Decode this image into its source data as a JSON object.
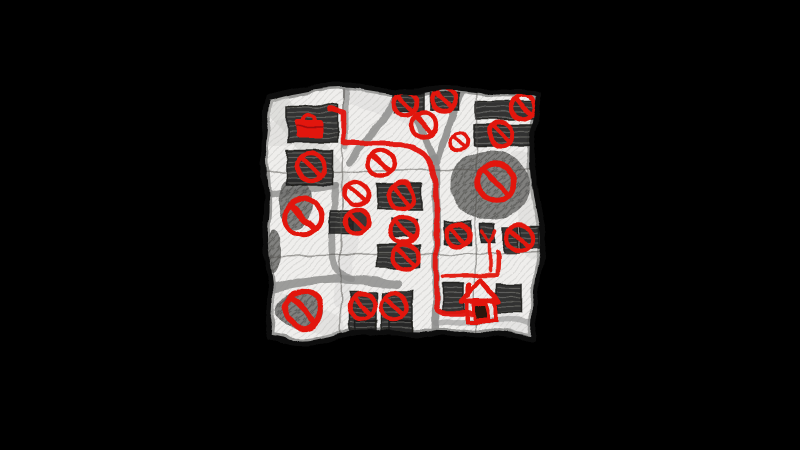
{
  "meta": {
    "kind": "hand-drawn-sketch-map",
    "background": "#000000"
  },
  "palette": {
    "paper": "#efeeec",
    "paper_shade": "#c6c6c3",
    "ink_outline": "#0c0c0c",
    "pencil_road": "#8d8d8c",
    "building_fill": "#282827",
    "building_stripe": "#565654",
    "foliage_fill": "#6e6e6c",
    "foliage_stripe": "#4e4e4c",
    "crease": "#4f4d4a",
    "red": "#e2150c",
    "door_fill": "#2a1410"
  },
  "paper": {
    "outline_path": "M268,97 C300,90 330,82 358,86 C385,90 405,95 428,90 C450,85 470,90 498,92 C515,93 530,91 539,95 C536,120 531,140 532,162 C533,185 537,205 542,228 C544,250 538,270 536,292 C535,310 534,325 533,340 C510,336 488,332 465,334 C445,336 425,333 405,334 C385,335 368,329 348,334 C330,338 312,346 295,343 C285,341 275,339 268,338 C270,315 272,298 269,278 C266,258 262,240 265,220 C267,200 264,182 263,162 C262,140 266,118 268,97 Z",
    "creases": [
      "M266,173 C350,168 450,174 537,169",
      "M263,257 C350,252 450,257 539,252",
      "M344,89 C341,170 342,260 340,338",
      "M478,92 C475,170 476,260 474,337"
    ],
    "shade_strokes": [
      {
        "d": "M276,101 L338,180",
        "w": 26,
        "o": 0.4
      },
      {
        "d": "M265,135 L302,130",
        "w": 26,
        "o": 0.3
      },
      {
        "d": "M352,95 L420,118",
        "w": 20,
        "o": 0.22
      },
      {
        "d": "M520,160 L534,250",
        "w": 20,
        "o": 0.3
      },
      {
        "d": "M270,300 L332,326",
        "w": 24,
        "o": 0.28
      },
      {
        "d": "M448,300 L530,330",
        "w": 18,
        "o": 0.22
      },
      {
        "d": "M350,240 L340,300",
        "w": 16,
        "o": 0.22
      }
    ]
  },
  "roads": [
    {
      "d": "M435,158 L437,220 L435,332",
      "w": 8,
      "o": 0.9
    },
    {
      "d": "M403,88 C414,112 426,136 434,160",
      "w": 7,
      "o": 0.9
    },
    {
      "d": "M400,89 C390,108 378,126 366,142 L350,162",
      "w": 7,
      "o": 0.85
    },
    {
      "d": "M464,88 C454,110 444,136 437,163",
      "w": 7,
      "o": 0.9
    },
    {
      "d": "M346,87 L346,146",
      "w": 6,
      "o": 0.7
    },
    {
      "d": "M264,196 C290,192 315,188 336,186",
      "w": 7,
      "o": 0.8
    },
    {
      "d": "M336,186 C333,210 331,235 334,258 C336,270 340,276 352,278",
      "w": 7,
      "o": 0.8
    },
    {
      "d": "M263,290 C295,282 330,277 358,280 L398,284",
      "w": 9,
      "o": 0.85
    },
    {
      "d": "M436,324 C470,320 505,319 536,322",
      "w": 6,
      "o": 0.55
    }
  ],
  "buildings": [
    [
      288,
      106,
      50,
      36
    ],
    [
      287,
      150,
      46,
      35
    ],
    [
      393,
      94,
      30,
      18
    ],
    [
      430,
      93,
      29,
      17
    ],
    [
      477,
      102,
      59,
      17
    ],
    [
      474,
      125,
      58,
      20
    ],
    [
      377,
      184,
      45,
      25
    ],
    [
      330,
      211,
      22,
      22
    ],
    [
      392,
      219,
      24,
      18
    ],
    [
      378,
      245,
      41,
      23
    ],
    [
      444,
      221,
      27,
      24
    ],
    [
      481,
      224,
      15,
      18
    ],
    [
      504,
      227,
      15,
      26
    ],
    [
      521,
      226,
      18,
      22
    ],
    [
      349,
      292,
      27,
      39
    ],
    [
      382,
      292,
      30,
      39
    ],
    [
      355,
      321,
      22,
      12
    ],
    [
      390,
      321,
      22,
      11
    ],
    [
      443,
      283,
      21,
      29
    ],
    [
      497,
      284,
      24,
      29
    ]
  ],
  "foliage": [
    [
      490,
      185,
      40,
      35
    ],
    [
      295,
      203,
      17,
      26
    ],
    [
      300,
      311,
      24,
      19
    ],
    [
      273,
      252,
      8,
      22
    ]
  ],
  "signs": {
    "ring_width_normal": 4.5,
    "ring_width_large": 5.5,
    "ring_width_small": 3.5,
    "items": [
      {
        "x": 405,
        "y": 104,
        "r": 12
      },
      {
        "x": 444,
        "y": 100,
        "r": 12
      },
      {
        "x": 424,
        "y": 125,
        "r": 12
      },
      {
        "x": 459,
        "y": 141,
        "r": 9
      },
      {
        "x": 523,
        "y": 107,
        "r": 12
      },
      {
        "x": 501,
        "y": 134,
        "r": 12
      },
      {
        "x": 311,
        "y": 167,
        "r": 14
      },
      {
        "x": 381,
        "y": 163,
        "r": 13
      },
      {
        "x": 356,
        "y": 193,
        "r": 12
      },
      {
        "x": 401,
        "y": 196,
        "r": 13
      },
      {
        "x": 303,
        "y": 217,
        "r": 18
      },
      {
        "x": 357,
        "y": 222,
        "r": 12,
        "v": "filled"
      },
      {
        "x": 404,
        "y": 230,
        "r": 13
      },
      {
        "x": 496,
        "y": 182,
        "r": 19
      },
      {
        "x": 458,
        "y": 235,
        "r": 12
      },
      {
        "x": 520,
        "y": 238,
        "r": 13
      },
      {
        "x": 406,
        "y": 257,
        "r": 12
      },
      {
        "x": 303,
        "y": 310,
        "r": 18
      },
      {
        "x": 362,
        "y": 306,
        "r": 13
      },
      {
        "x": 394,
        "y": 306,
        "r": 13
      }
    ]
  },
  "route": {
    "d": "M330,110 L344,114 L344,142 L402,143 C417,147 427,155 432,168 C436,182 437,195 437,215 L436,305 C436,311 441,313 448,313 L471,313",
    "w": 5.5
  },
  "extra_marks": [
    {
      "name": "house-block-line",
      "d": "M443,276 L497,275 L498,252",
      "w": 4
    },
    {
      "name": "arrow-mark",
      "d": "M483,231 L490,242 L497,230 M490,242 L490,271",
      "w": 3.5
    }
  ],
  "markers": {
    "briefcase": {
      "x": 309,
      "y": 128
    },
    "house": {
      "x": 481,
      "y": 301
    }
  }
}
